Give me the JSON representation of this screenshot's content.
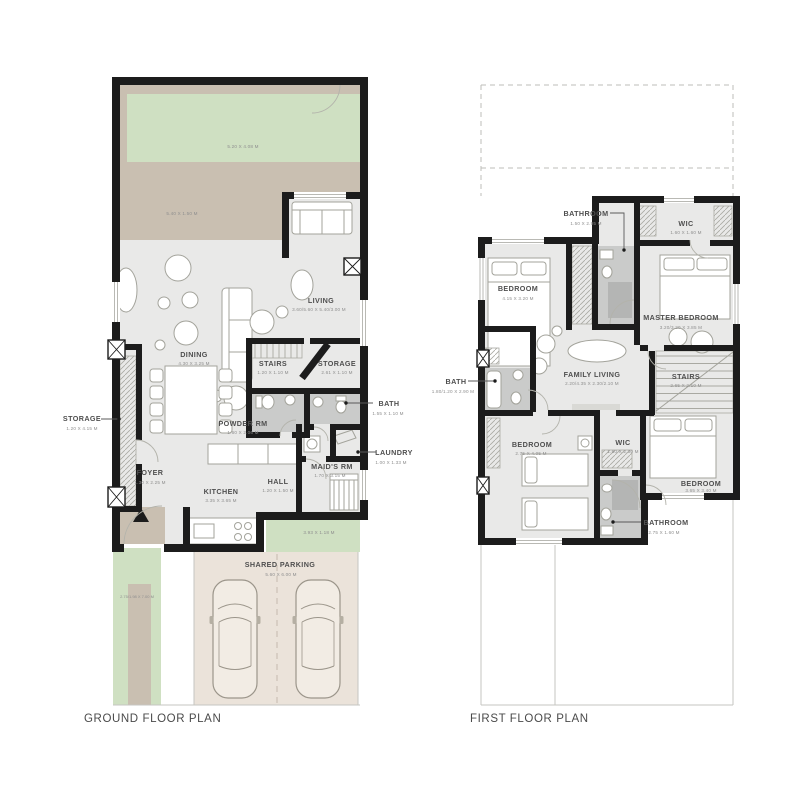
{
  "ground": {
    "title": "GROUND FLOOR PLAN",
    "garden": {
      "dims": "5.20 X 4.08 M"
    },
    "terrace": {
      "dims": "5.40 X 1.50 M"
    },
    "living": {
      "label": "LIVING",
      "dims": "3.60/5.60 X 5.40/3.00 M"
    },
    "dining": {
      "label": "DINING",
      "dims": "4.30 X 3.25 M"
    },
    "stairs": {
      "label": "STAIRS",
      "dims": "1.20 X 1.10 M"
    },
    "storage_mid": {
      "label": "STORAGE",
      "dims": "2.61 X 1.10 M"
    },
    "powder": {
      "label": "POWDER RM",
      "dims": "1.60 X 2.06 M"
    },
    "bath": {
      "label": "BATH",
      "dims": "1.55 X 1.10 M"
    },
    "laundry": {
      "label": "LAUNDRY",
      "dims": "1.00 X 1.33 M"
    },
    "maids": {
      "label": "MAID'S RM",
      "dims": "1.70 X 3.15 M"
    },
    "storage_left": {
      "label": "STORAGE",
      "dims": "1.20 X 4.15 M"
    },
    "foyer": {
      "label": "FOYER",
      "dims": "1.30 X 2.25 M"
    },
    "kitchen": {
      "label": "KITCHEN",
      "dims": "3.35 X 3.65 M"
    },
    "hall": {
      "label": "HALL",
      "dims": "1.20 X 1.50 M"
    },
    "rear_yard": {
      "dims": "3.93 X 1.18 M"
    },
    "side_yard": {
      "dims": "2.75/1.98 X 7.00 M"
    },
    "parking": {
      "label": "SHARED PARKING",
      "dims": "5.60 X 6.00 M"
    }
  },
  "first": {
    "title": "FIRST FLOOR PLAN",
    "bathroom_top": {
      "label": "BATHROOM",
      "dims": "1.50 X 2.95 M"
    },
    "wic_top": {
      "label": "WIC",
      "dims": "1.60 X 1.60 M"
    },
    "bedroom_left": {
      "label": "BEDROOM",
      "dims": "4.15 X 3.20 M"
    },
    "master_bedroom": {
      "label": "MASTER BEDROOM",
      "dims": "3.20/3.20 X 3.85 M"
    },
    "family_living": {
      "label": "FAMILY LIVING",
      "dims": "2.20/4.35 X 2.30/2.10 M"
    },
    "stairs": {
      "label": "STAIRS",
      "dims": "2.65 X 2.10 M"
    },
    "bath_left": {
      "label": "BATH",
      "dims": "1.80/1.20 X 2.90 M"
    },
    "bedroom_bl": {
      "label": "BEDROOM",
      "dims": "2.75 X 4.05 M"
    },
    "wic_bottom": {
      "label": "WIC",
      "dims": "1.60 X 2.30 M"
    },
    "bedroom_br": {
      "label": "BEDROOM",
      "dims": "3.65 X 3.40 M"
    },
    "bathroom_bottom": {
      "label": "BATHROOM",
      "dims": "2.75 X 1.60 M"
    }
  },
  "colors": {
    "wall": "#1c1c1c",
    "floor": "#e9e9e8",
    "garden_green": "#cfe0c2",
    "terrace_tan": "#c9bfb1",
    "parking_tan": "#ebe3da",
    "wet_gray": "#cacbca",
    "label_text": "#4f4f4f",
    "dim_text": "#8e8e8e"
  }
}
